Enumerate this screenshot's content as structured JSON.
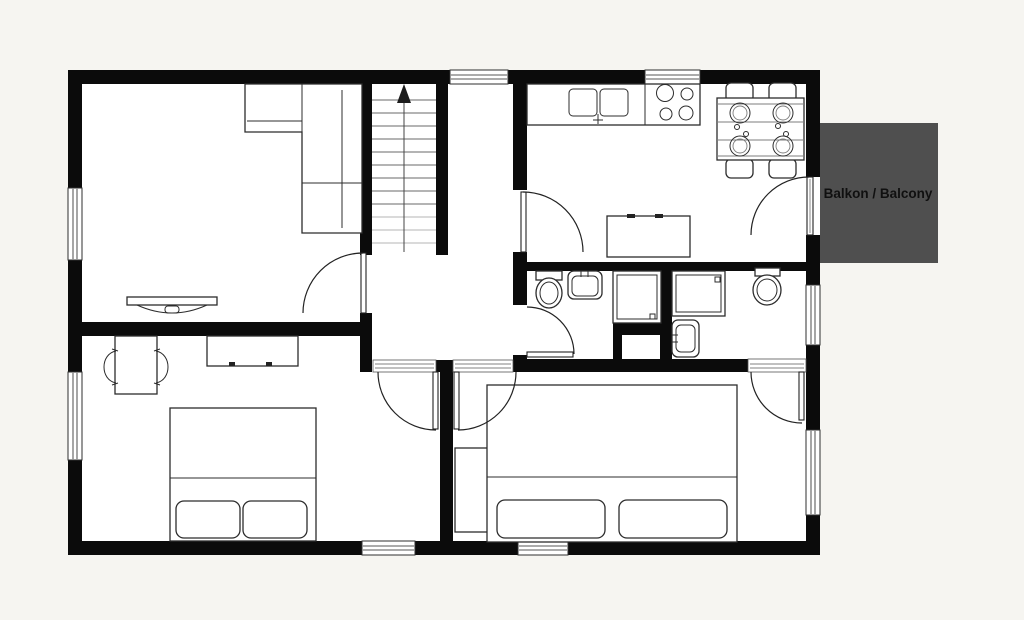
{
  "balcony": {
    "label": "Balkon / Balcony"
  },
  "colors": {
    "background": "#f6f5f1",
    "floor": "#ffffff",
    "wall": "#0b0b0b",
    "outline": "#2c2c2c",
    "window_line": "#8f8f8f",
    "balcony_fill": "#4f4f4f",
    "balcony_text": "#101010"
  }
}
